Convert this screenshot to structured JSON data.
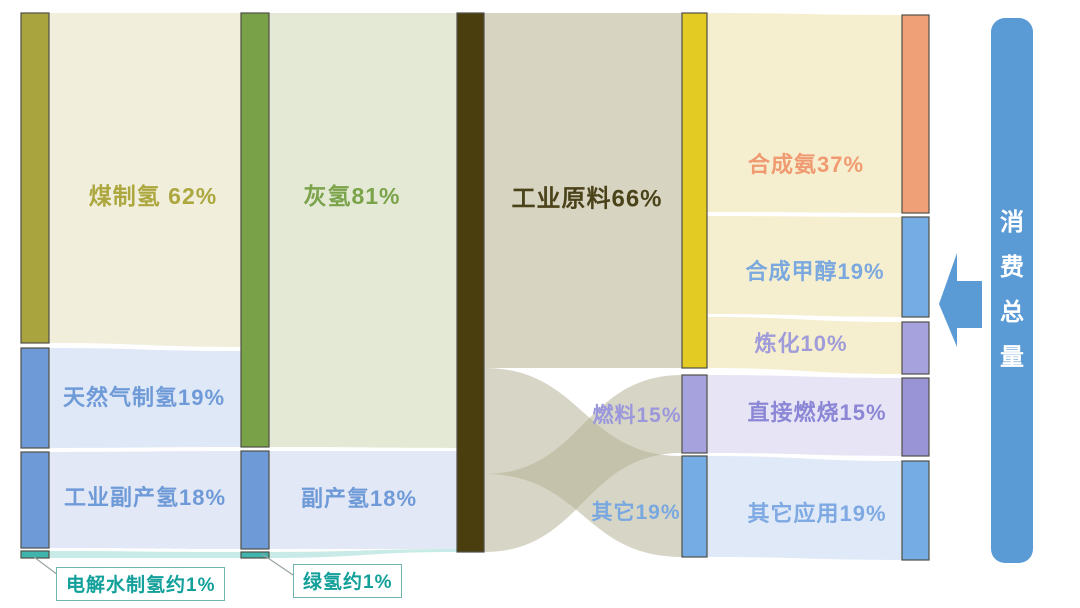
{
  "chart_data": {
    "type": "sankey",
    "unit": "%",
    "title": "",
    "stages": [
      {
        "name": "hydrogen-production-method",
        "nodes": [
          {
            "label": "煤制氢",
            "value": 62
          },
          {
            "label": "天然气制氢",
            "value": 19
          },
          {
            "label": "工业副产氢",
            "value": 18
          },
          {
            "label": "电解水制氢",
            "value": 1,
            "approx": true
          }
        ]
      },
      {
        "name": "hydrogen-type",
        "nodes": [
          {
            "label": "灰氢",
            "value": 81
          },
          {
            "label": "副产氢",
            "value": 18
          },
          {
            "label": "绿氢",
            "value": 1,
            "approx": true
          }
        ]
      },
      {
        "name": "hydrogen-total",
        "nodes": [
          {
            "label": "",
            "value": 100
          }
        ]
      },
      {
        "name": "usage-category",
        "nodes": [
          {
            "label": "工业原料",
            "value": 66
          },
          {
            "label": "燃料",
            "value": 15
          },
          {
            "label": "其它",
            "value": 19
          }
        ]
      },
      {
        "name": "application",
        "nodes": [
          {
            "label": "合成氨",
            "value": 37
          },
          {
            "label": "合成甲醇",
            "value": 19
          },
          {
            "label": "炼化",
            "value": 10
          },
          {
            "label": "直接燃烧",
            "value": 15
          },
          {
            "label": "其它应用",
            "value": 19
          }
        ]
      }
    ],
    "links": [
      {
        "from": "煤制氢",
        "to": "灰氢",
        "value": 62
      },
      {
        "from": "天然气制氢",
        "to": "灰氢",
        "value": 19
      },
      {
        "from": "工业副产氢",
        "to": "副产氢",
        "value": 18
      },
      {
        "from": "电解水制氢",
        "to": "绿氢",
        "value": 1
      },
      {
        "from": "灰氢",
        "to": "氢总量",
        "value": 81
      },
      {
        "from": "副产氢",
        "to": "氢总量",
        "value": 18
      },
      {
        "from": "绿氢",
        "to": "氢总量",
        "value": 1
      },
      {
        "from": "氢总量",
        "to": "工业原料",
        "value": 66
      },
      {
        "from": "氢总量",
        "to": "其它",
        "value": 19,
        "crossing": true
      },
      {
        "from": "氢总量",
        "to": "燃料",
        "value": 15,
        "crossing": true
      },
      {
        "from": "工业原料",
        "to": "合成氨",
        "value": 37
      },
      {
        "from": "工业原料",
        "to": "合成甲醇",
        "value": 19
      },
      {
        "from": "工业原料",
        "to": "炼化",
        "value": 10
      },
      {
        "from": "燃料",
        "to": "直接燃烧",
        "value": 15
      },
      {
        "from": "其它",
        "to": "其它应用",
        "value": 19
      }
    ],
    "legend_position": "none",
    "annotation": "消费总量 arrow pointing left at the application column"
  },
  "labels": {
    "coal": "煤制氢 62%",
    "natural_gas": "天然气制氢19%",
    "industrial_byproduct": "工业副产氢18%",
    "electrolysis_callout": "电解水制氢约1%",
    "grey_hydrogen": "灰氢81%",
    "byproduct_hydrogen": "副产氢18%",
    "green_callout": "绿氢约1%",
    "industrial_feedstock": "工业原料66%",
    "fuel": "燃料15%",
    "other": "其它19%",
    "ammonia": "合成氨37%",
    "methanol": "合成甲醇19%",
    "refining": "炼化10%",
    "direct_combustion": "直接燃烧15%",
    "other_applications": "其它应用19%",
    "total_consumption": "消费总量"
  },
  "palette": {
    "node_olive": "#a9a43e",
    "node_green": "#79a148",
    "node_blue": "#6f9ad8",
    "node_teal": "#3fb5ad",
    "node_dark": "#4a3d0e",
    "node_yellow": "#e3cb24",
    "node_lavender": "#a6a2de",
    "node_purple": "#9894d6",
    "node_blue2": "#74ace3",
    "node_salmon": "#f0a077",
    "node_stroke": "#4f4f46",
    "flow_cream": "#f1eedb",
    "flow_blue": "#dfe8f7",
    "flow_bluegray": "#e3e8f6",
    "flow_teal": "#c9ebe7",
    "flow_sage": "#e4e9d6",
    "flow_tan": "#d8d4c2",
    "flow_tan_cross": "#b7b295",
    "flow_cream2": "#f6efcf",
    "flow_lavender": "#e7e5f5",
    "flow_blue2": "#dfe9f8",
    "accent_blue": "#5b9bd5",
    "teal_text": "#13a09a",
    "leader_line": "#97a3a3"
  }
}
